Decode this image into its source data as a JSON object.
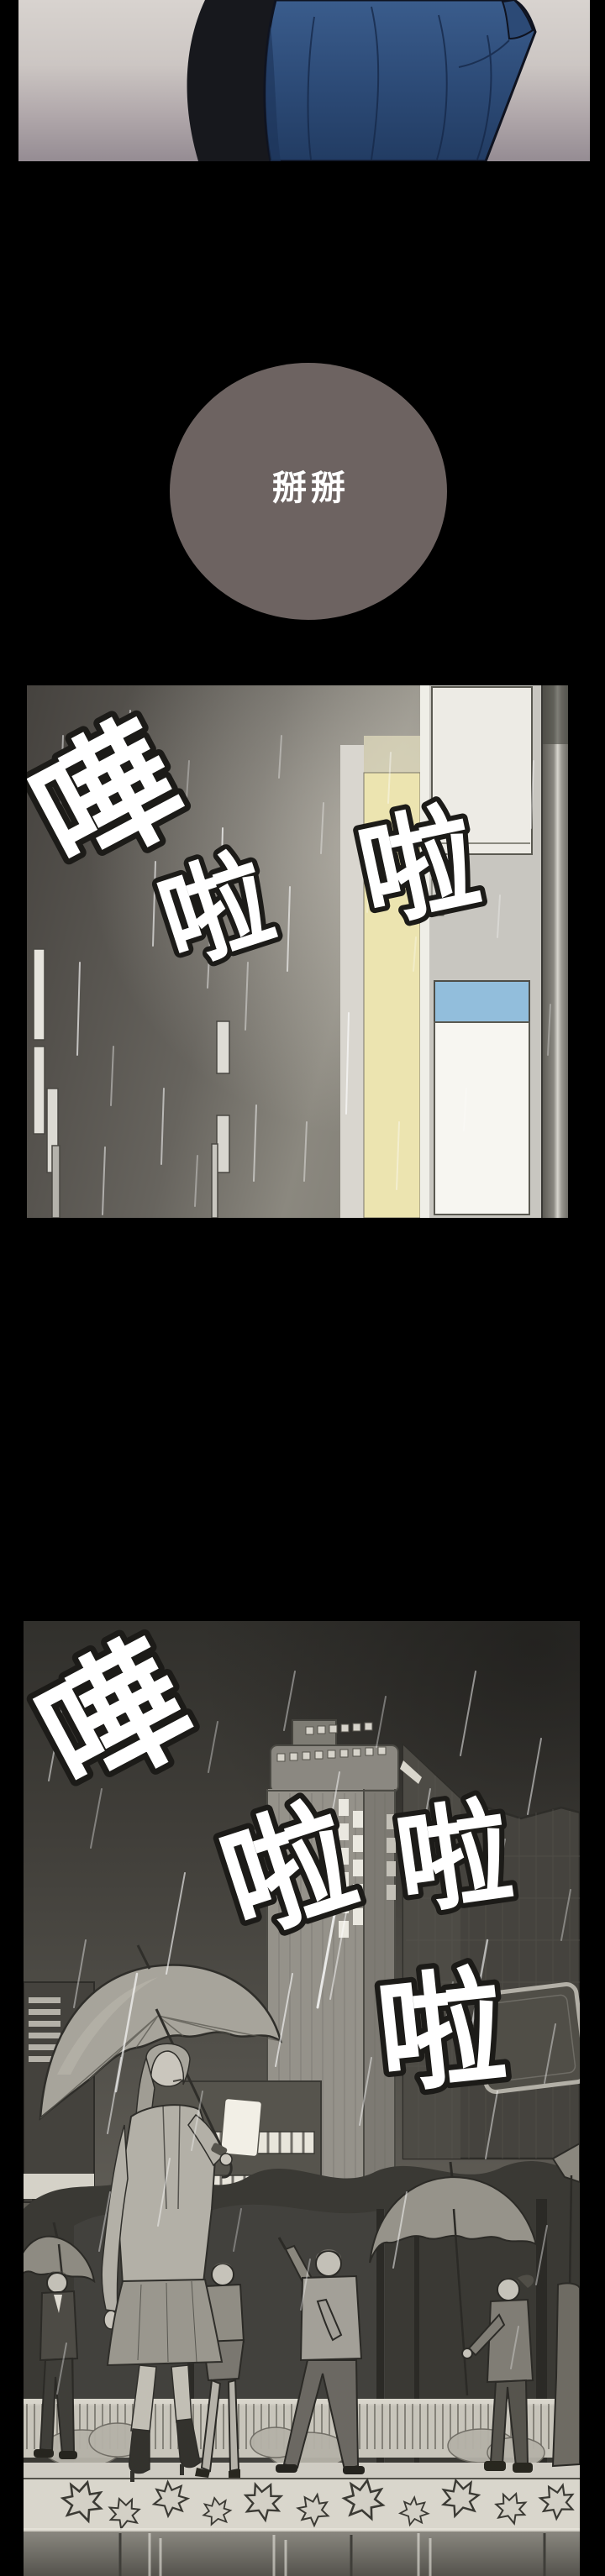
{
  "comic": {
    "panel1": {
      "alt": "back of a person wearing a blue hooded jacket against a pale gradient wall"
    },
    "speech_bubble": {
      "text": "掰掰"
    },
    "panel2": {
      "sfx": [
        "嘩",
        "啦",
        "啦"
      ],
      "alt": "heavy rain pouring at night beside lit city buildings"
    },
    "panel3": {
      "sfx": [
        "嘩",
        "啦",
        "啦",
        "啦"
      ],
      "alt": "crowd of pedestrians with umbrellas walking in rain below tall buildings"
    }
  },
  "colors": {
    "page_background": "#000000",
    "bubble_fill": "#6d6361",
    "bubble_text": "#ffffff",
    "hoodie_blue": "#2f4e7a",
    "inner_garment": "#17181d",
    "panel1_wall_top": "#d8d3cf",
    "panel1_wall_bottom": "#958c93",
    "yellow_building": "#ece4b0",
    "blue_window": "#92bedc",
    "white_window": "#f7f6f1",
    "sfx_fill": "#ffffff",
    "sfx_outline": "#1c1b18",
    "rain": "#ffffff"
  }
}
